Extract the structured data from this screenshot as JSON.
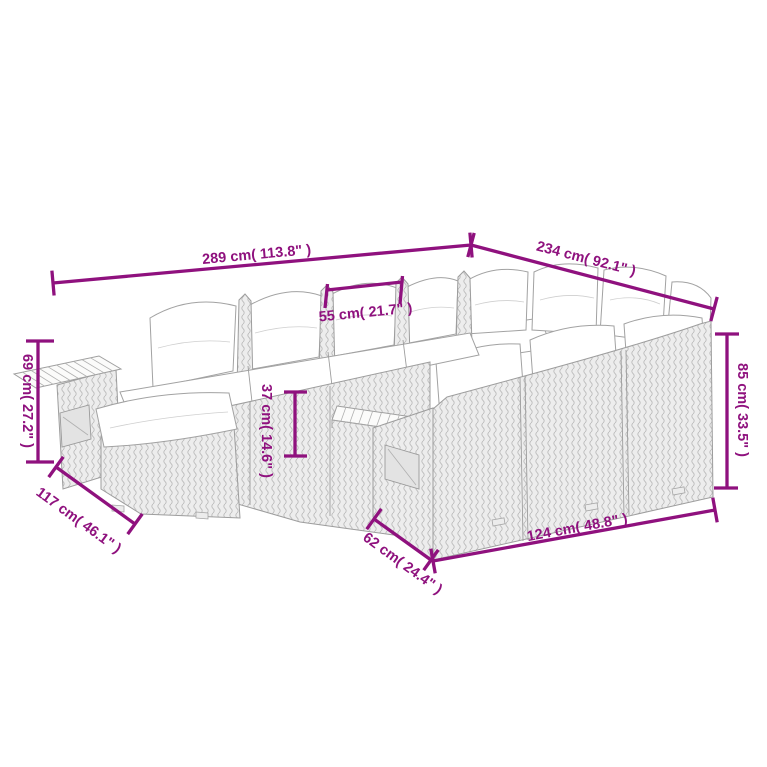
{
  "page": {
    "background_color": "#FFFFFF",
    "kind": "product-dimension-diagram",
    "subject": "outdoor poly rattan lounge sofa set with cushions, line drawing with measurements"
  },
  "diagram": {
    "accent_color": "#8F117E",
    "art_line_color": "#A5A5A5",
    "wicker_fill_color": "#EDEDED",
    "cushion_color": "#FFFFFF",
    "dimensions": {
      "overall_width": {
        "label": "289 cm( 113.8\" )",
        "value_cm": 289,
        "value_in": 113.8
      },
      "overall_depth": {
        "label": "234 cm( 92.1\" )",
        "value_cm": 234,
        "value_in": 92.1
      },
      "seat_module_width": {
        "label": "55 cm( 21.7\" )",
        "value_cm": 55,
        "value_in": 21.7
      },
      "armrest_height": {
        "label": "69 cm( 27.2\" )",
        "value_cm": 69,
        "value_in": 27.2
      },
      "seat_height": {
        "label": "37 cm( 14.6\" )",
        "value_cm": 37,
        "value_in": 14.6
      },
      "back_height": {
        "label": "85 cm( 33.5\" )",
        "value_cm": 85,
        "value_in": 33.5
      },
      "left_section_depth": {
        "label": "117 cm( 46.1\" )",
        "value_cm": 117,
        "value_in": 46.1
      },
      "right_section_depth": {
        "label": "62 cm( 24.4\" )",
        "value_cm": 62,
        "value_in": 24.4
      },
      "right_section_length": {
        "label": "124 cm( 48.8\" )",
        "value_cm": 124,
        "value_in": 48.8
      }
    }
  }
}
